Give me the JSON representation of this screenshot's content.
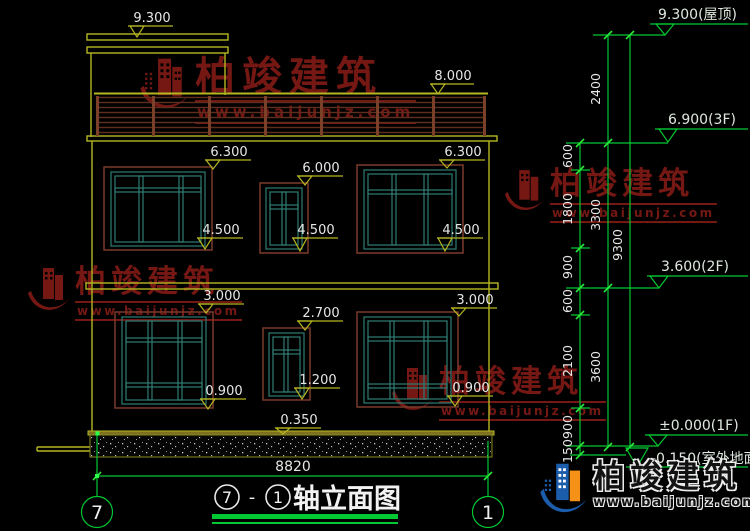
{
  "drawing_title": {
    "axis_from": "7",
    "dash": "-",
    "axis_to": "1",
    "text": "轴立面图"
  },
  "axis_bubbles": {
    "left": "7",
    "right": "1"
  },
  "total_width_dim": "8820",
  "elev_marks": {
    "roof": "9.300",
    "rail_top": "8.000",
    "w2f_left_top": "6.300",
    "w2f_mid_top": "6.000",
    "w2f_right_top": "6.300",
    "w2f_left_sill": "4.500",
    "w2f_mid_sill": "4.500",
    "w2f_right_sill": "4.500",
    "w1f_left_top": "3.000",
    "w1f_right_top": "3.000",
    "w1f_mid_top": "2.700",
    "w1f_mid_sill": "1.200",
    "w1f_left_sill": "0.900",
    "w1f_right_sill": "0.900",
    "plinth": "0.350"
  },
  "levels": {
    "roof": "9.300(屋顶)",
    "f3": "6.900(3F)",
    "f2": "3.600(2F)",
    "f1": "±0.000(1F)",
    "ground": "-0.150(室外地面)"
  },
  "dim_chains": {
    "c1": [
      "600",
      "1800",
      "900",
      "600",
      "2100",
      "900",
      "150"
    ],
    "c2": [
      "2400",
      "3300",
      "3600"
    ],
    "c3": [
      "9300"
    ]
  },
  "watermark": {
    "name": "柏竣建筑",
    "url": "www.baijunjz.com"
  },
  "colors": {
    "wall_yellow": "#b6b622",
    "dim_green": "#00c832",
    "frame_brown": "#7a3a2a",
    "window_teal": "#2f7d74",
    "watermark_red": "#7c1a16",
    "text_white": "#e6e6e6"
  }
}
